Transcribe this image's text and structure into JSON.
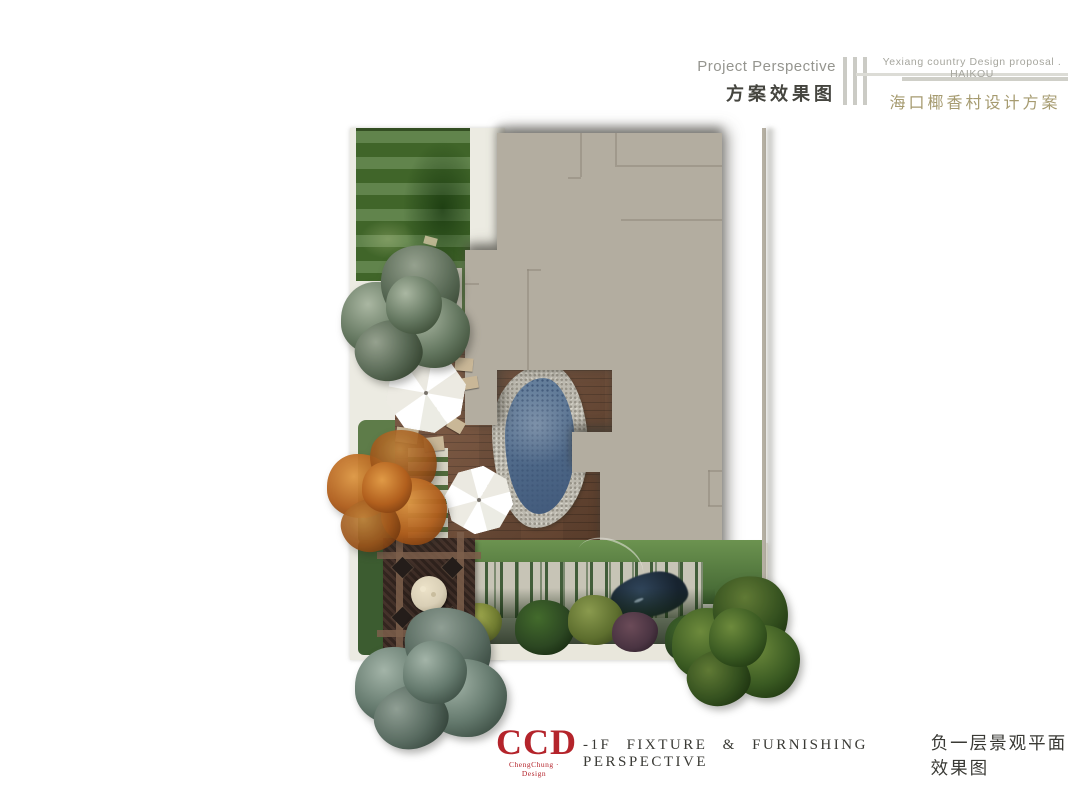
{
  "header": {
    "section_en": "Project Perspective",
    "section_cn": "方案效果图",
    "proposal_en": "Yexiang country Design proposal . HAIKOU",
    "proposal_cn": "海口椰香村设计方案"
  },
  "footer": {
    "logo_text": "CCD",
    "logo_subtext": "ChengChung · Design",
    "caption_en": "-1F FIXTURE & FURNISHING PERSPECTIVE",
    "caption_cn": "负一层景观平面效果图"
  },
  "plan": {
    "description": "Top-down rendered landscape plan of the -1F courtyard",
    "elements": [
      "lawn",
      "building-footprint",
      "boundary-wall",
      "wood-deck",
      "plunge-pool",
      "patio-umbrella-1",
      "patio-umbrella-2",
      "stepping-stone-path",
      "slat-path",
      "pergola-dining-platform",
      "round-dining-table",
      "dining-chairs",
      "fence-screen",
      "shrub-border",
      "water-feature",
      "canopy-tree-gray-green",
      "canopy-tree-autumn-orange",
      "canopy-tree-blue-gray",
      "canopy-tree-dark-green"
    ]
  },
  "colors": {
    "logo-red": "#b4242b",
    "title-olive": "#a69b70",
    "header-gray": "#95958f",
    "building-taupe": "#b3ada0",
    "deck-brown": "#7b533a",
    "water-blue": "#4d6787",
    "lawn-green": "#47702e"
  }
}
